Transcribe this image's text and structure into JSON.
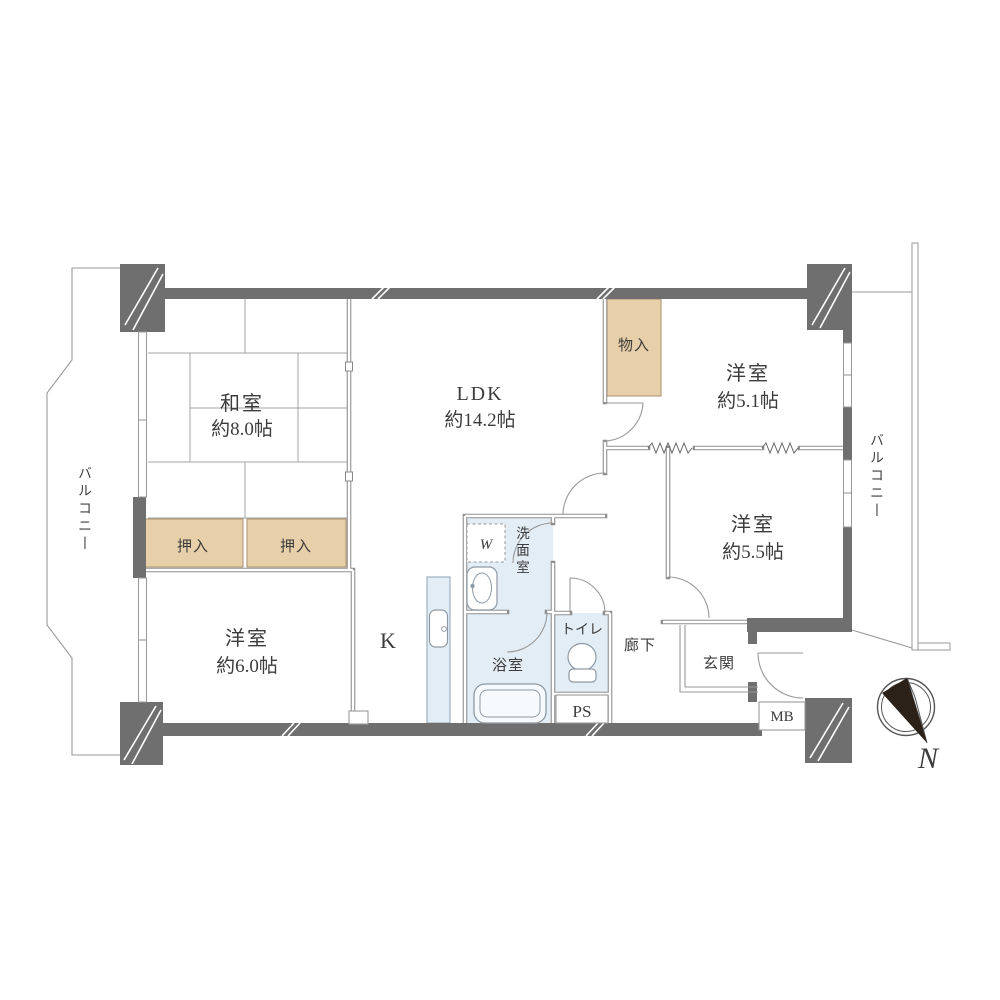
{
  "floorplan": {
    "rooms": {
      "washitsu": {
        "name": "和室",
        "size": "約8.0帖"
      },
      "ldk": {
        "name": "LDK",
        "size": "約14.2帖"
      },
      "western_5_1": {
        "name": "洋室",
        "size": "約5.1帖"
      },
      "western_5_5": {
        "name": "洋室",
        "size": "約5.5帖"
      },
      "western_6_0": {
        "name": "洋室",
        "size": "約6.0帖"
      },
      "kitchen": "K",
      "washroom": "洗面室",
      "bathroom": "浴室",
      "toilet": "トイレ",
      "hallway": "廊下",
      "entrance": "玄関"
    },
    "storage": {
      "oshiire_left": "押入",
      "oshiire_right": "押入",
      "monoire": "物入"
    },
    "utility": {
      "ps": "PS",
      "mb": "MB",
      "washer": "W"
    },
    "balcony": {
      "left": "バルコニー",
      "right": "バルコニー"
    },
    "compass": {
      "north": "N"
    },
    "colors": {
      "wall": "#6f6f6f",
      "closet_fill": "#e7cfa9",
      "water_fill": "#e2edf5",
      "line": "#999999",
      "text": "#3c3c3c",
      "needle": "#2b2119"
    }
  }
}
